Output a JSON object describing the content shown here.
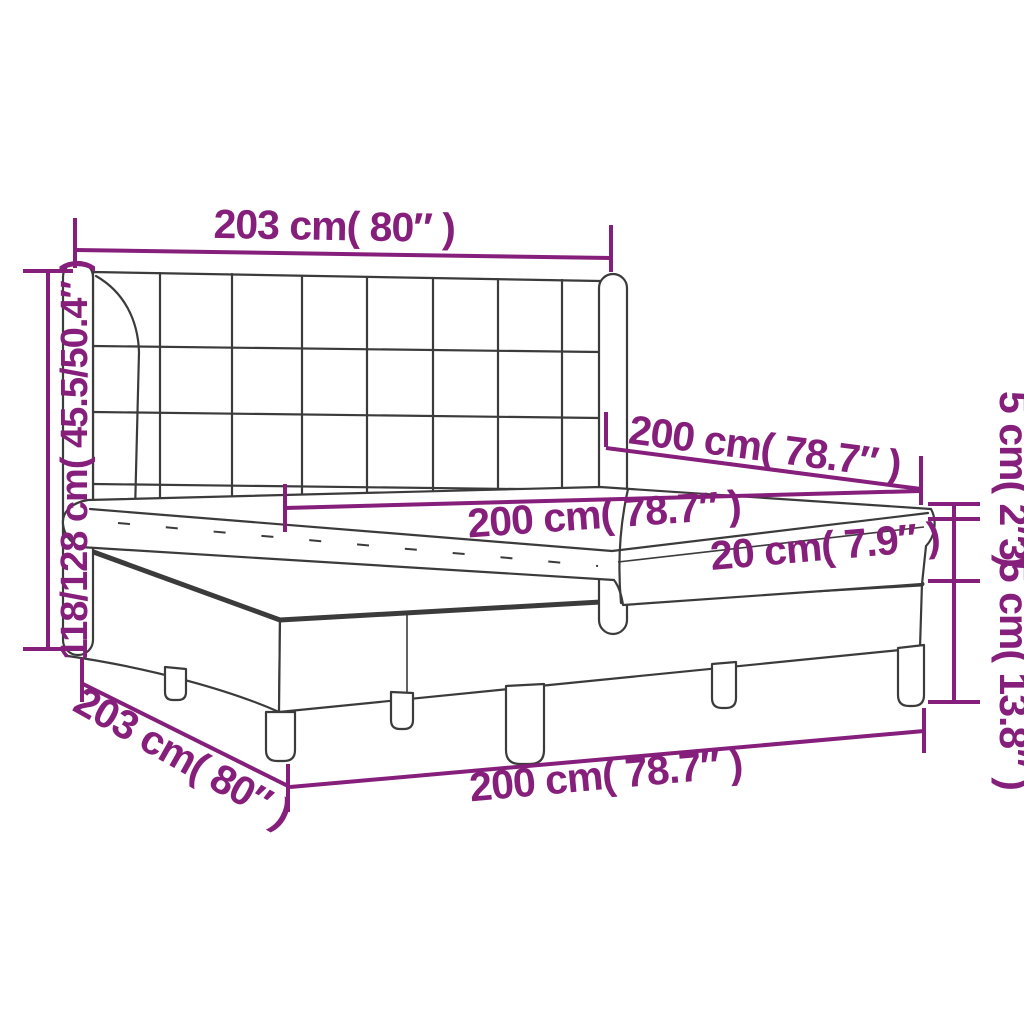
{
  "diagram": {
    "kind": "product-dimension-diagram",
    "subject": "box spring bed with tufted headboard, split base and mattress",
    "colors": {
      "dimension_accent": "#861e7b",
      "drawing_outline": "#3b3b3b",
      "background": "#ffffff"
    },
    "labels": {
      "headboard_width": "203 cm( 80″ )",
      "bed_height": "118/128 cm( 45.5/50.4″ )",
      "bed_length": "200 cm( 78.7″ )",
      "mattress_width": "200 cm( 78.7″ )",
      "mattress_thickness": "20 cm( 7.9″ )",
      "topper_thickness": "5 cm( 2″ )",
      "base_height": "35 cm( 13.8″ )",
      "base_length": "203 cm( 80″ )",
      "base_width": "200 cm( 78.7″ )"
    }
  }
}
